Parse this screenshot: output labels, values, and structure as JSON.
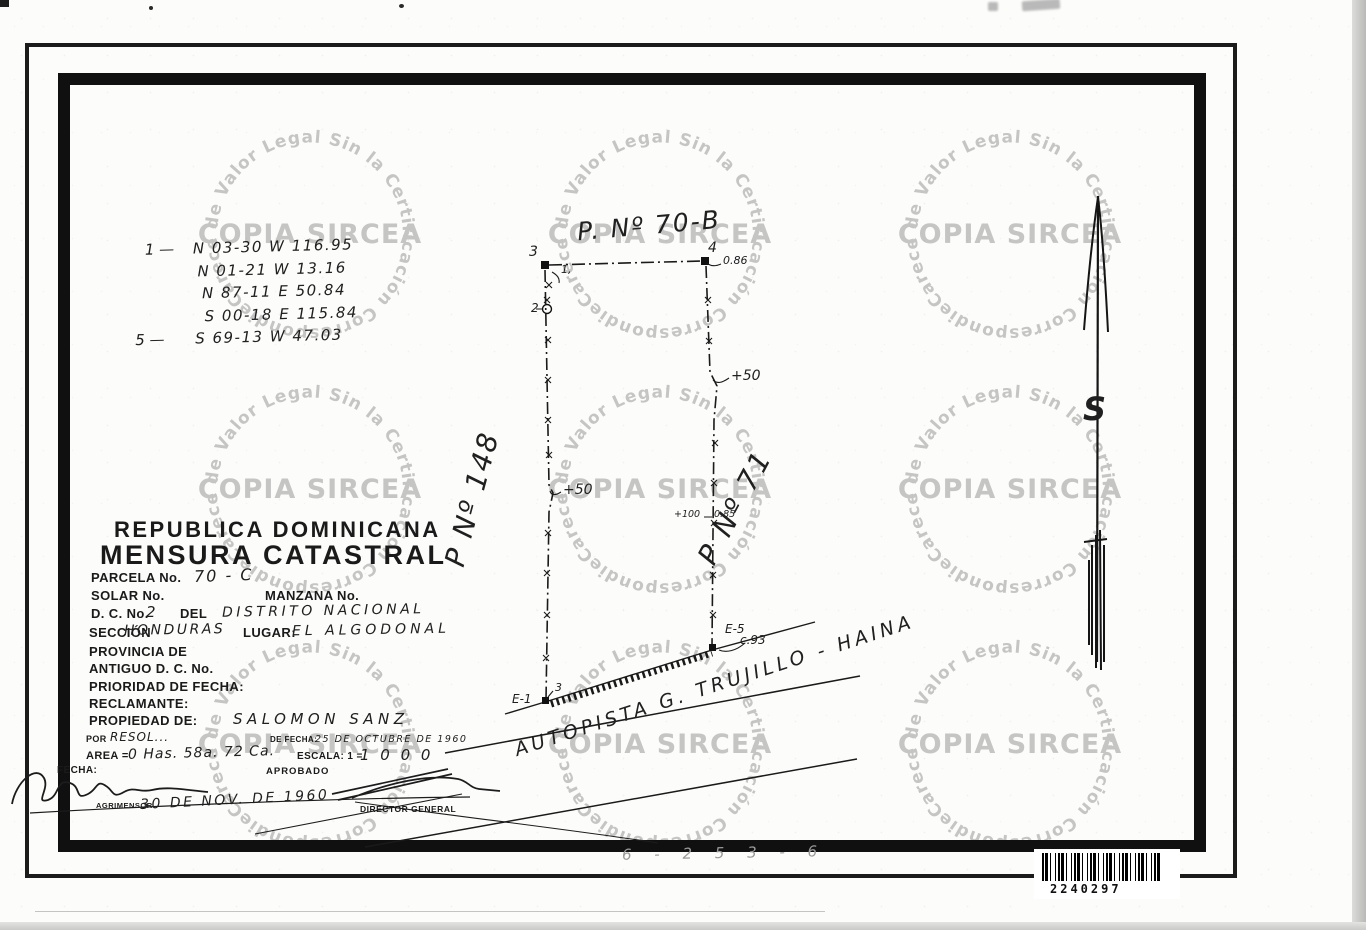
{
  "watermark": {
    "ring_text": "Carece de Valor Legal Sin la Certificación Correspondiente,",
    "center_text": "COPIA SIRCEA"
  },
  "bearings": {
    "lines": [
      {
        "prefix": "1 —",
        "text": "N 03-30 W   116.95"
      },
      {
        "prefix": "",
        "text": "N 01-21 W   13.16"
      },
      {
        "prefix": "",
        "text": "N 87-11 E   50.84"
      },
      {
        "prefix": "",
        "text": "S 00-18 E   115.84"
      },
      {
        "prefix": "5 —",
        "text": "S 69-13 W   47.03"
      }
    ]
  },
  "title_block": {
    "country": "REPUBLICA DOMINICANA",
    "title": "MENSURA CATASTRAL",
    "parcela_label": "PARCELA No.",
    "parcela_value": "70 - C",
    "solar_label": "SOLAR No.",
    "manzana_label": "MANZANA No.",
    "dc_label": "D. C. No.",
    "dc_value": "2",
    "del_label": "DEL",
    "dc_name": "DISTRITO NACIONAL",
    "seccion_label": "SECCIÓN",
    "seccion_value": "HONDURAS",
    "lugar_label": "LUGAR:",
    "lugar_value": "EL ALGODONAL",
    "provincia_label": "PROVINCIA DE",
    "antiguo_label": "ANTIGUO D. C. No.",
    "prioridad_label": "PRIORIDAD DE FECHA:",
    "reclamante_label": "RECLAMANTE:",
    "propiedad_label": "PROPIEDAD DE:",
    "propiedad_value": "SALOMON SANZ",
    "por_label": "POR",
    "por_value": "RESOL...",
    "de_fecha_label": "DE FECHA:",
    "de_fecha_value": "25 DE OCTUBRE DE 1960",
    "area_label": "AREA =",
    "area_value": "0 Has. 58a. 72 Ca.",
    "escala_label": "ESCALA: 1 =",
    "escala_value": "1 0 0 0",
    "fecha_label": "FECHA:",
    "aprobado_label": "APROBADO",
    "agrimensor_label": "AGRIMENSOR",
    "agrimensor_date": "30 DE NOV. DE 1960",
    "director_label": "DIRECTOR GENERAL"
  },
  "plot": {
    "parcel_top_label": "P. Nº 70-B",
    "parcel_left_label": "P Nº 148",
    "parcel_right_label": "P Nº 71",
    "road_label": "AUTOPISTA  G. TRUJILLO - HAINA",
    "point_3": "3",
    "point_4": "4",
    "point_2": "2",
    "point_1_note": "1,",
    "e1_label": "E-1",
    "e1_point": "3",
    "e5_label": "E-5",
    "meas_086": "0.86",
    "meas_plus50": "+50",
    "meas_plus100": "+100",
    "meas_085": "0.85",
    "meas_c93": "c.93"
  },
  "north_arrow": {
    "label": "S"
  },
  "stamps": {
    "barcode_number": "2240297",
    "bottom_code": "6 - 2 5 3 - 6"
  }
}
